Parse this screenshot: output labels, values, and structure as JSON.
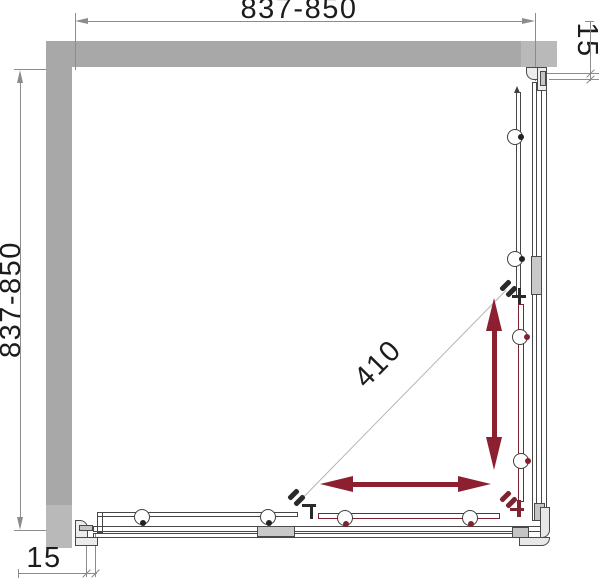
{
  "drawing": {
    "type": "shower-enclosure-plan-drawing",
    "dimensions": {
      "top_width": "837-850",
      "left_height": "837-850",
      "right_gap": "15",
      "bottom_gap": "15",
      "diagonal_entry": "410"
    },
    "colors": {
      "wall_gray": "#a8a8a8",
      "wall_gray_light": "#b9b9b9",
      "profile_line": "#474747",
      "dimension_line": "#8c8c8c",
      "diagonal_line": "#b5b5b5",
      "slide_arrow_red": "#8d2030",
      "door_highlight_red": "#7e2230",
      "text": "#1c1c1c"
    },
    "components": {
      "walls": [
        "top-wall",
        "left-wall"
      ],
      "glass_sides": [
        "right-fixed-panel",
        "bottom-fixed-panel"
      ],
      "sliding_doors": [
        "right-sliding-door",
        "bottom-sliding-door"
      ],
      "icons": [
        "roller-icon",
        "door-handle-icon",
        "slide-direction-arrow",
        "corner-profile"
      ]
    }
  }
}
